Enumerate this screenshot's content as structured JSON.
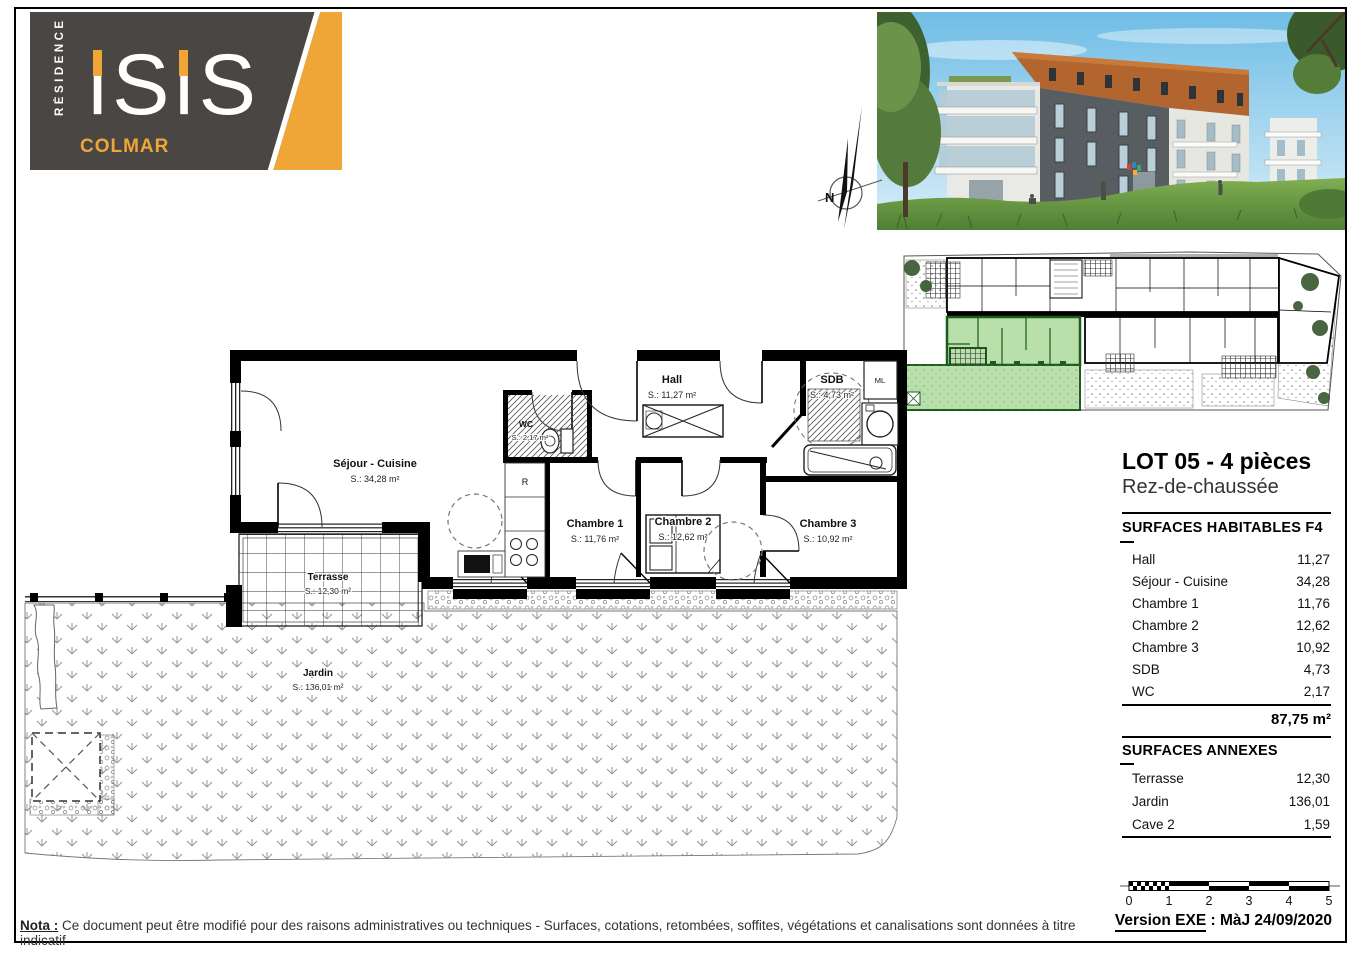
{
  "colors": {
    "accent_yellow": "#F0A637",
    "logo_background": "#494643",
    "unit_green_fill": "#B9E0AA",
    "unit_green_wall": "#1D5A1D"
  },
  "logo": {
    "residence": "RÉSIDENCE",
    "name": "iSiS",
    "city": "COLMAR"
  },
  "compass": {
    "label": "N"
  },
  "header": {
    "lot_title": "LOT 05 - 4 pièces",
    "floor": "Rez-de-chaussée"
  },
  "surfaces_habitables": {
    "header": "SURFACES HABITABLES F4",
    "rows": [
      {
        "label": "Hall",
        "value": "11,27"
      },
      {
        "label": "Séjour - Cuisine",
        "value": "34,28"
      },
      {
        "label": "Chambre 1",
        "value": "11,76"
      },
      {
        "label": "Chambre 2",
        "value": "12,62"
      },
      {
        "label": "Chambre 3",
        "value": "10,92"
      },
      {
        "label": "SDB",
        "value": "4,73"
      },
      {
        "label": "WC",
        "value": "2,17"
      }
    ],
    "total": "87,75 m²"
  },
  "surfaces_annexes": {
    "header": "SURFACES ANNEXES",
    "rows": [
      {
        "label": "Terrasse",
        "value": "12,30"
      },
      {
        "label": "Jardin",
        "value": "136,01"
      },
      {
        "label": "Cave 2",
        "value": "1,59"
      }
    ]
  },
  "plan": {
    "rooms": [
      {
        "name": "Séjour - Cuisine",
        "area": "S.: 34,28 m²"
      },
      {
        "name": "Hall",
        "area": "S.: 11,27 m²"
      },
      {
        "name": "WC",
        "area": "S.: 2,17 m²"
      },
      {
        "name": "SDB",
        "area": "S.: 4,73 m²"
      },
      {
        "name": "Chambre 1",
        "area": "S.: 11,76 m²"
      },
      {
        "name": "Chambre 2",
        "area": "S.: 12,62 m²"
      },
      {
        "name": "Chambre 3",
        "area": "S.: 10,92 m²"
      },
      {
        "name": "Terrasse",
        "area": "S.: 12,30 m²"
      },
      {
        "name": "Jardin",
        "area": "S.: 136,01 m²"
      }
    ],
    "labels": {
      "washing_machine": "ML",
      "fridge": "R"
    }
  },
  "scalebar": {
    "ticks": [
      "0",
      "1",
      "2",
      "3",
      "4",
      "5"
    ]
  },
  "version": {
    "label": "Version EXE",
    "rest": " : MàJ 24/09/2020"
  },
  "nota": {
    "label": "Nota :",
    "text": " Ce document peut être modifié pour des raisons administratives ou techniques - Surfaces, cotations, retombées, soffites, végétations et canalisations sont données à titre indicatif"
  }
}
